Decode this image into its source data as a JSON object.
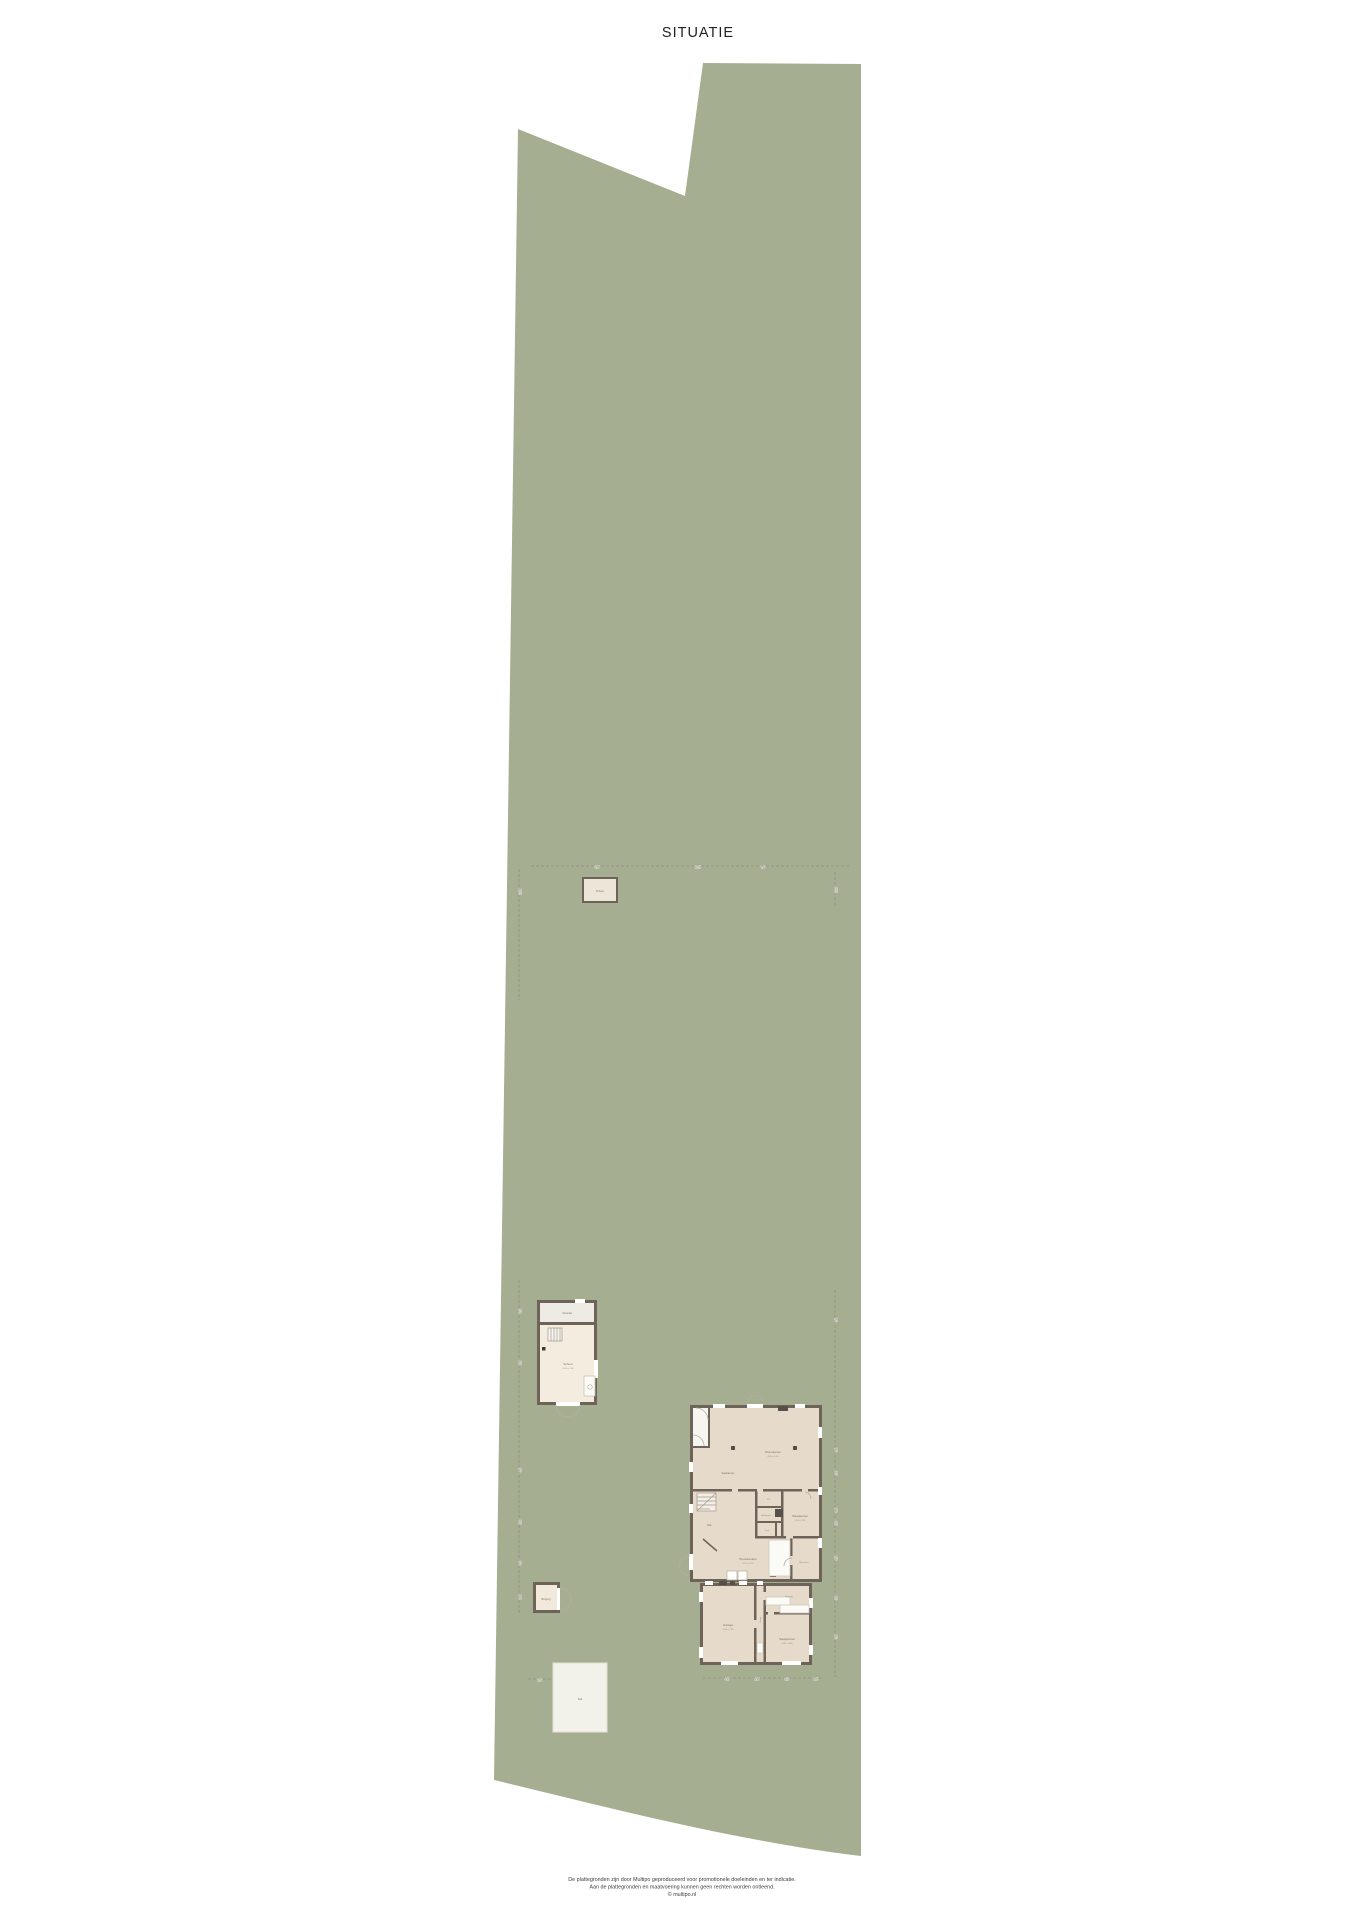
{
  "title": "SITUATIE",
  "footer": {
    "line1": "De plattegronden zijn door Multipo geproduceerd voor promotionele doeleinden en ter indicatie.",
    "line2": "Aan de plattegronden en maatvoering kunnen geen rechten worden ontleend.",
    "line3": "© multipo.nl"
  },
  "colors": {
    "site_green": "#a5ae91",
    "wall": "#6e6358",
    "interior": "#e6dbca",
    "interior_light": "#f3ecdf",
    "white_surface": "#f7f5f0",
    "dash": "#8d917c",
    "accent_dark": "#55504a"
  },
  "house_rooms": {
    "woonkamer": {
      "label": "Woonkamer",
      "size": "8.05 x 4.00"
    },
    "eetkamer": {
      "label": "Eetkamer"
    },
    "hal": {
      "label": "Hal"
    },
    "wc": {
      "label": "WC"
    },
    "badkamer": {
      "label": "Badkamer"
    },
    "kast": {
      "label": "Kast"
    },
    "slaapkamer_1": {
      "label": "Slaapkamer",
      "size": "3.55 x 3.95"
    },
    "woonkeuken": {
      "label": "Woonkeuken",
      "size": "6.10 x 4.20"
    },
    "bijkeuken": {
      "label": "Bijkeuken"
    },
    "garage": {
      "label": "Garage",
      "size": "5.00 x 7.30"
    },
    "gang": {
      "label": "Gang"
    },
    "berging": {
      "label": "Berging"
    },
    "slaapkamer_2": {
      "label": "Slaapkamer",
      "size": "4.30 x 4.60"
    }
  },
  "outbuildings": {
    "schuur_noord": {
      "label": "Schuur"
    },
    "tuinschuur": {
      "label": "Schuur",
      "size": "5.45 x 7.65",
      "veranda_label": "Veranda"
    },
    "berging_klein": {
      "label": "Berging"
    },
    "stal": {
      "label": "Stal"
    }
  },
  "dims": {
    "top": [
      "6.55",
      "10.15",
      "8.90"
    ],
    "left": [
      "11.25",
      "2.10",
      "8.25",
      "4.90",
      "5.20",
      "3.40",
      "2.80"
    ],
    "right": [
      "11.20",
      "4.50",
      "4.60",
      "2.30",
      "3.60",
      "1.30",
      "3.50",
      "4.00",
      "4.70"
    ],
    "house_bottom": [
      "4.47",
      "2.95",
      "3.20",
      "2.87"
    ],
    "stal_left": [
      "2.50"
    ]
  }
}
